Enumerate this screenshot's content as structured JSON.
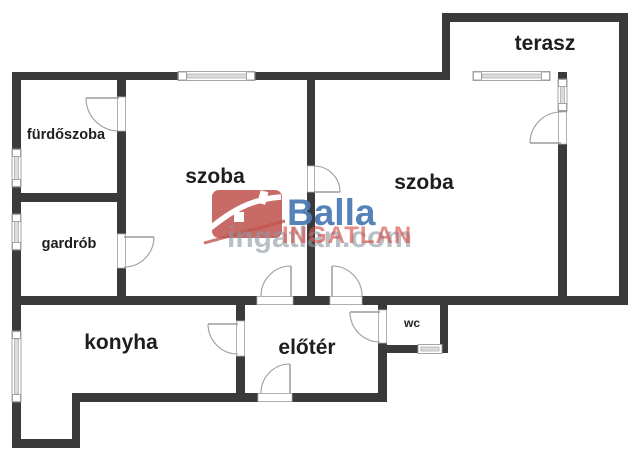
{
  "page": {
    "background": "#ffffff"
  },
  "floor_plan": {
    "wall_color": "#3a3a3a",
    "line_color": "#9c9c9c",
    "rooms": [
      {
        "id": "terasz",
        "label": "terasz"
      },
      {
        "id": "furdoszoba",
        "label": "fürdőszoba"
      },
      {
        "id": "szoba_left",
        "label": "szoba"
      },
      {
        "id": "szoba_right",
        "label": "szoba"
      },
      {
        "id": "gardrob",
        "label": "gardrób"
      },
      {
        "id": "konyha",
        "label": "konyha"
      },
      {
        "id": "eloter",
        "label": "előtér"
      },
      {
        "id": "wc",
        "label": "wc"
      }
    ]
  },
  "watermark": {
    "brand": "Balla",
    "overlay_red": "INGATLAN",
    "overlay_gray": "ingatlan.com",
    "brand_blue": "#4d7cb7",
    "brand_red": "#c05551",
    "overlay_gray_color": "#9098a4"
  }
}
